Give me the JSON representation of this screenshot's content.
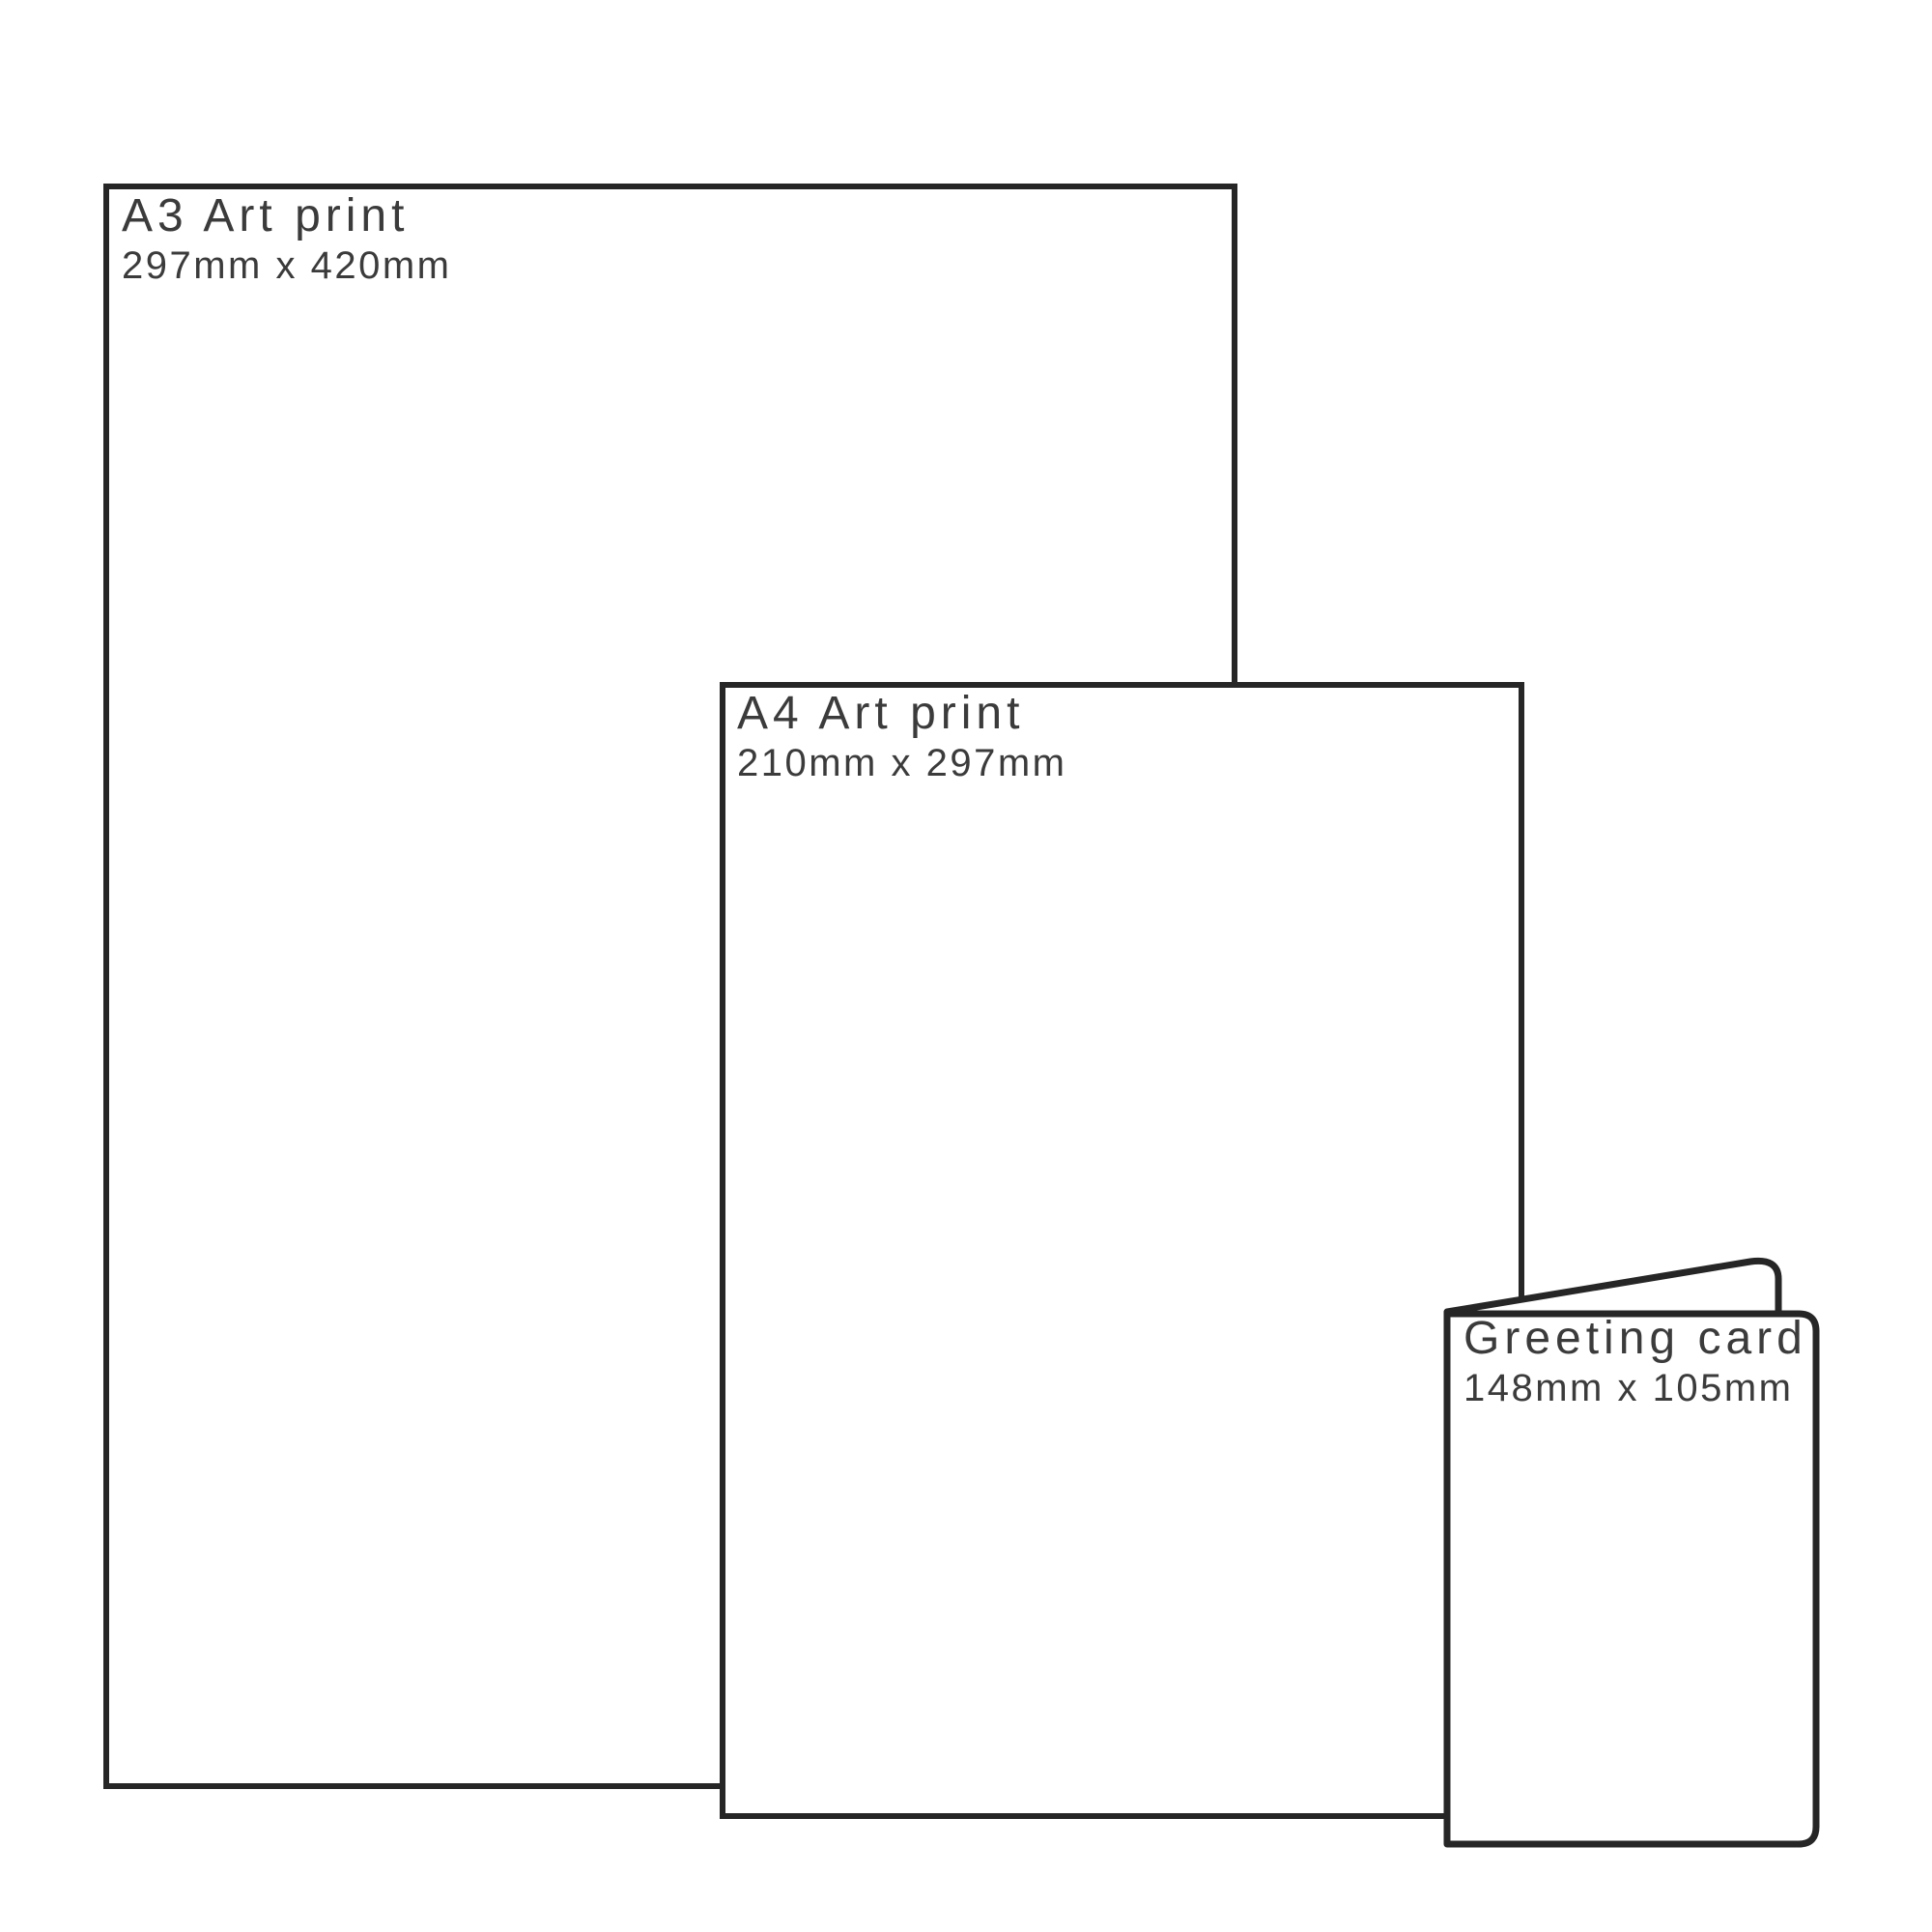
{
  "colors": {
    "outline": "#262626",
    "text": "#3b3b3b",
    "background": "#ffffff"
  },
  "panels": [
    {
      "id": "a3-art-print",
      "label": "A3 Art print",
      "size": "297mm x 420mm"
    },
    {
      "id": "a4-art-print",
      "label": "A4 Art print",
      "size": "210mm x 297mm"
    },
    {
      "id": "greeting-card",
      "label": "Greeting card",
      "size": "148mm x 105mm"
    }
  ]
}
